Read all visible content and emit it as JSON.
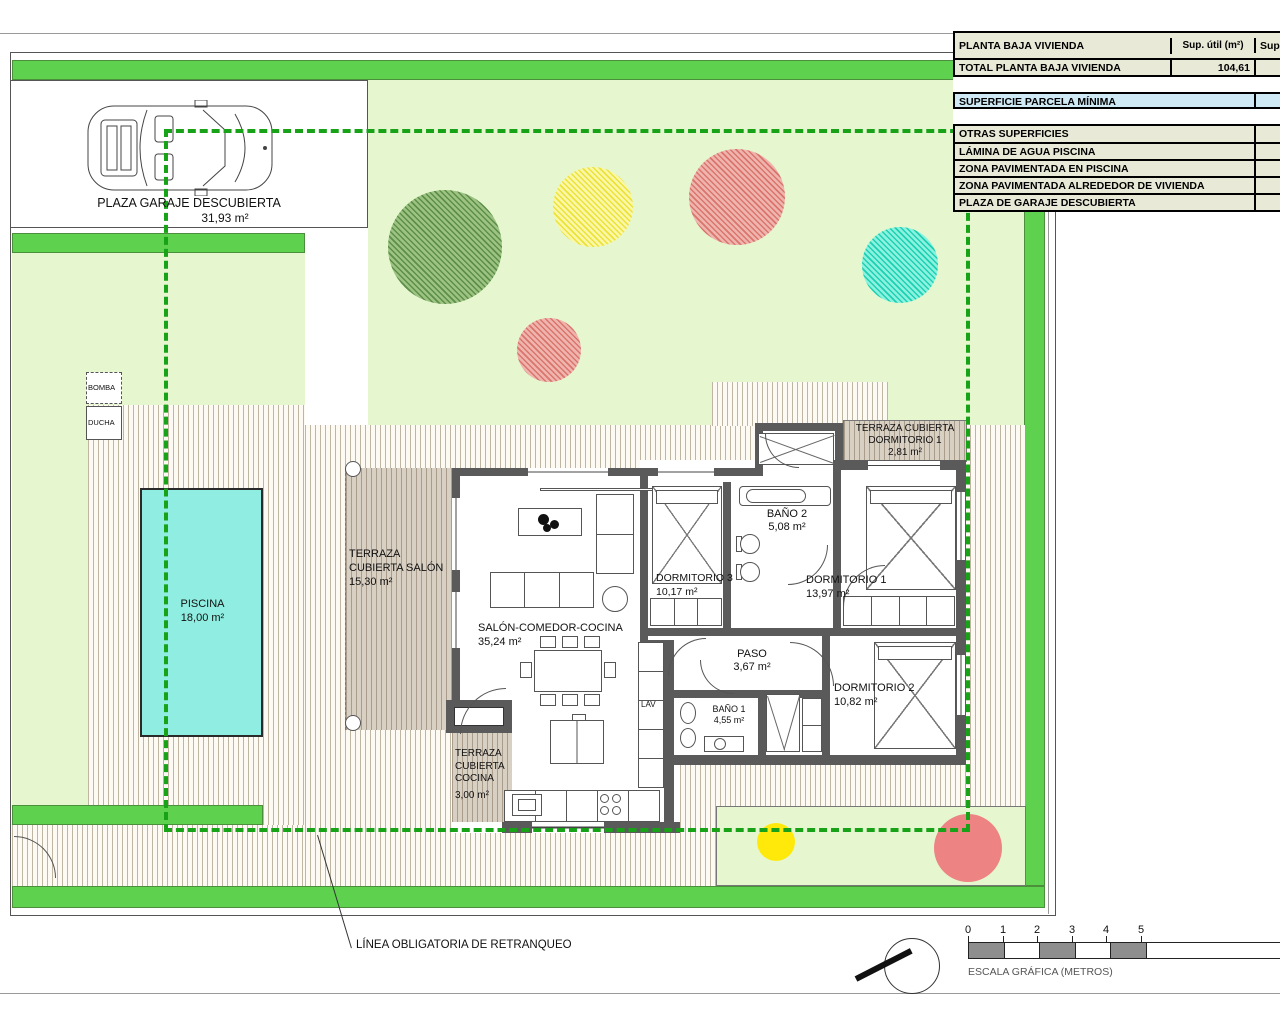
{
  "title_table": {
    "header": {
      "col1": "PLANTA BAJA VIVIENDA",
      "col2": "Sup. útil (m²)",
      "col3": "Sup."
    },
    "total": {
      "label": "TOTAL PLANTA BAJA VIVIENDA",
      "value": "104,61"
    },
    "parcela": {
      "label": "SUPERFICIE PARCELA MÍNIMA"
    },
    "otras": {
      "label": "OTRAS SUPERFICIES"
    },
    "rows": [
      {
        "label": "LÁMINA DE AGUA PISCINA"
      },
      {
        "label": "ZONA PAVIMENTADA EN PISCINA"
      },
      {
        "label": "ZONA PAVIMENTADA ALREDEDOR DE VIVIENDA"
      },
      {
        "label": "PLAZA DE GARAJE DESCUBIERTA"
      }
    ]
  },
  "rooms": {
    "garage": {
      "name": "PLAZA GARAJE DESCUBIERTA",
      "area": "31,93 m²"
    },
    "piscina": {
      "name": "PISCINA",
      "area": "18,00 m²"
    },
    "terraza_salon": {
      "name": "TERRAZA CUBIERTA SALÓN",
      "area": "15,30 m²"
    },
    "salon": {
      "name": "SALÓN-COMEDOR-COCINA",
      "area": "35,24 m²"
    },
    "dorm3": {
      "name": "DORMITORIO 3",
      "area": "10,17 m²"
    },
    "bano2": {
      "name": "BAÑO 2",
      "area": "5,08 m²"
    },
    "dorm1": {
      "name": "DORMITORIO 1",
      "area": "13,97 m²"
    },
    "terraza_dorm1": {
      "name": "TERRAZA CUBIERTA DORMITORIO 1",
      "area": "2,81 m²"
    },
    "paso": {
      "name": "PASO",
      "area": "3,67 m²"
    },
    "dorm2": {
      "name": "DORMITORIO 2",
      "area": "10,82 m²"
    },
    "bano1": {
      "name": "BAÑO 1",
      "area": "4,55 m²"
    },
    "terraza_cocina": {
      "name": "TERRAZA CUBIERTA COCINA",
      "area": "3,00 m²"
    },
    "bomba": "BOMBA",
    "ducha": "DUCHA",
    "lav": "LAV"
  },
  "annotations": {
    "retranqueo": "LÍNEA OBLIGATORIA DE RETRANQUEO",
    "escala": "ESCALA GRÁFICA (METROS)",
    "scale_ticks": [
      "0",
      "1",
      "2",
      "3",
      "4",
      "5"
    ]
  },
  "colors": {
    "setback_dashed_green": "#17a217",
    "strip_green": "#5ed14e",
    "lawn_light_green": "#e6f7d0",
    "pool_cyan": "#8feee1",
    "table_row_beige": "#e9e9d8",
    "table_row_blue": "#cfe9f5",
    "wall_gray": "#5a5a5a",
    "tree_green": "#7aa55e",
    "tree_yellow": "#f4ee62",
    "tree_red": "#e2887f",
    "tree_teal": "#35dfc2"
  }
}
